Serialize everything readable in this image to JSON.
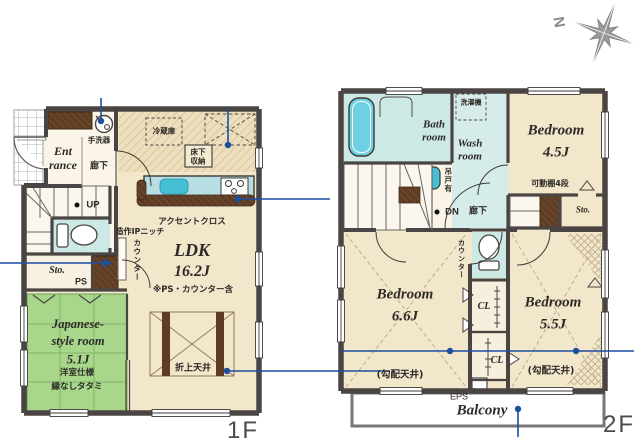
{
  "labels": {
    "floor1": "1F",
    "floor2": "2F"
  },
  "compass": {
    "north": "N"
  },
  "colors": {
    "wall": "#4a4543",
    "floor": "#f2e6cb",
    "wet": "#cde9e6",
    "tatami": "#a8d68b",
    "wood": "#5f3d24",
    "counter": "#b7dee3",
    "sink": "#45c0d6",
    "annotation": "#1e4f9f"
  },
  "f1": {
    "entrance_l1": "Ent",
    "entrance_l2": "rance",
    "hallway": "廊下",
    "handwash": "手洗器",
    "up": "UP",
    "sto": "Sto.",
    "ps": "PS",
    "niche": "造作IPニッチ",
    "counter": "カウンター",
    "fridge": "冷蔵庫",
    "underfloor_l1": "床下",
    "underfloor_l2": "収納",
    "accent": "アクセントクロス",
    "ldk": "LDK",
    "ldk_size": "16.2J",
    "ldk_note": "※PS・カウンター含",
    "coffered": "折上天井",
    "jroom_l1": "Japanese-",
    "jroom_l2": "style room",
    "jroom_size": "5.1J",
    "jroom_note1": "洋室仕様",
    "jroom_note2": "縁なしタタミ"
  },
  "f2": {
    "bath_l1": "Bath",
    "bath_l2": "room",
    "washer": "洗濯機",
    "wash_l1": "Wash",
    "wash_l2": "room",
    "hanging": "吊戸有",
    "bed1": "Bedroom",
    "bed1_size": "4.5J",
    "shelf": "可動棚4段",
    "sto": "Sto.",
    "dn": "DN",
    "hallway": "廊下",
    "counter": "カウンター",
    "bed2": "Bedroom",
    "bed2_size": "6.6J",
    "bed3": "Bedroom",
    "bed3_size": "5.5J",
    "slope": "(勾配天井)",
    "cl": "CL",
    "eps": "EPS",
    "balcony": "Balcony"
  }
}
